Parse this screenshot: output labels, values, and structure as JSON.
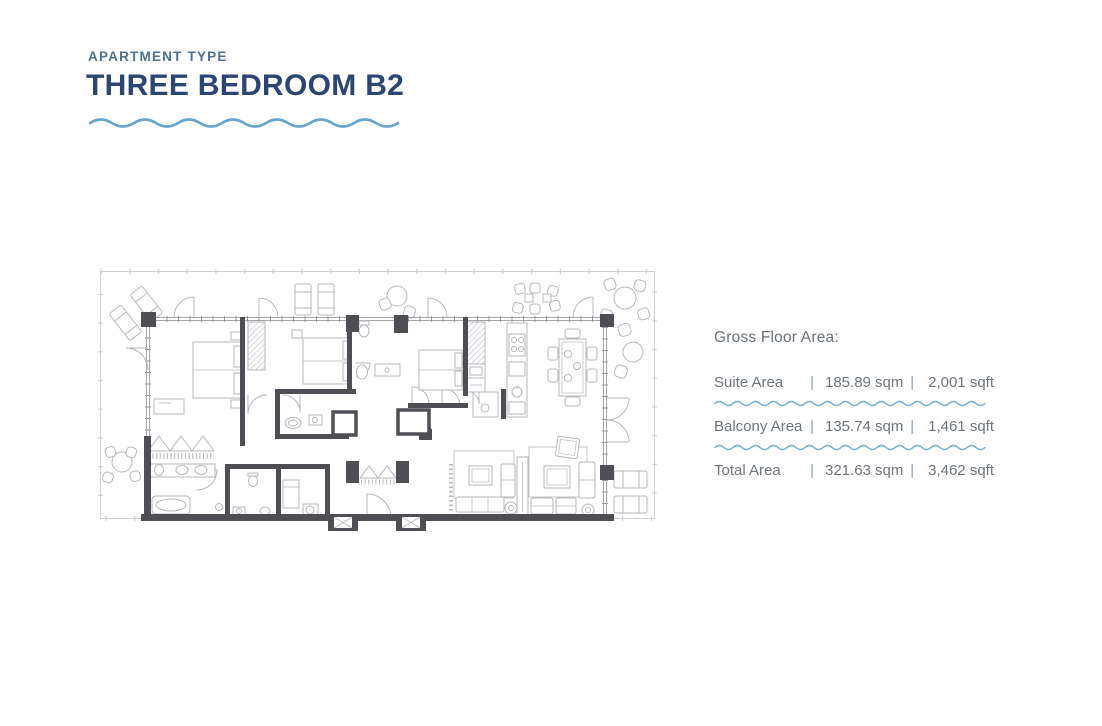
{
  "header": {
    "eyebrow": "APARTMENT TYPE",
    "title": "THREE BEDROOM B2",
    "eyebrow_color": "#4d7195",
    "title_color": "#2b4672",
    "wave_color": "#68a6ce"
  },
  "floorplan": {
    "description": "three-bedroom-b2-floor-plan",
    "wall_color": "#4e4e55",
    "furniture_line_color": "#b7b7bd"
  },
  "area_panel": {
    "heading": "Gross Floor Area:",
    "separator": "|",
    "text_color": "#6e747b",
    "divider_color": "#74aed2",
    "rows": [
      {
        "label": "Suite Area",
        "sqm": "185.89 sqm",
        "sqft": "2,001 sqft"
      },
      {
        "label": "Balcony Area",
        "sqm": "135.74 sqm",
        "sqft": "1,461 sqft"
      },
      {
        "label": "Total Area",
        "sqm": "321.63 sqm",
        "sqft": "3,462 sqft"
      }
    ]
  }
}
